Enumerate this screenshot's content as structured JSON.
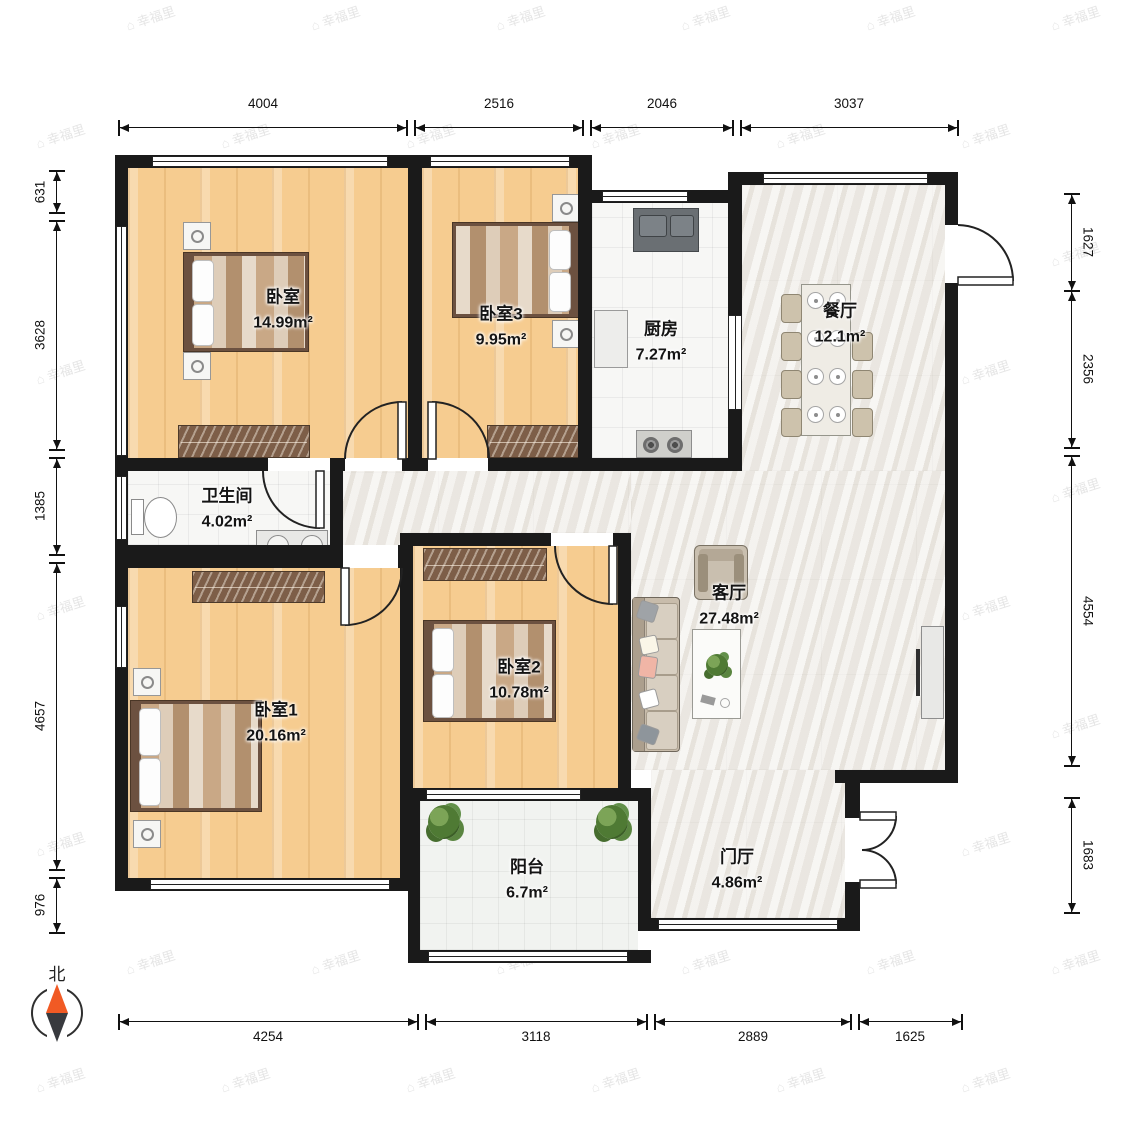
{
  "watermark": {
    "logo": "⌂",
    "text": "幸福里"
  },
  "compass": {
    "label": "北"
  },
  "rooms": {
    "master": {
      "name": "卧室",
      "area": "14.99m²"
    },
    "bedroom3": {
      "name": "卧室3",
      "area": "9.95m²"
    },
    "kitchen": {
      "name": "厨房",
      "area": "7.27m²"
    },
    "dining": {
      "name": "餐厅",
      "area": "12.1m²"
    },
    "bath": {
      "name": "卫生间",
      "area": "4.02m²"
    },
    "bedroom1": {
      "name": "卧室1",
      "area": "20.16m²"
    },
    "bedroom2": {
      "name": "卧室2",
      "area": "10.78m²"
    },
    "living": {
      "name": "客厅",
      "area": "27.48m²"
    },
    "balcony": {
      "name": "阳台",
      "area": "6.7m²"
    },
    "foyer": {
      "name": "门厅",
      "area": "4.86m²"
    }
  },
  "dimensions": {
    "top": [
      "4004",
      "2516",
      "2046",
      "3037"
    ],
    "bottom": [
      "4254",
      "3118",
      "2889",
      "1625"
    ],
    "left": [
      "631",
      "3628",
      "1385",
      "4657",
      "976"
    ],
    "right": [
      "1627",
      "2356",
      "4554",
      "1683"
    ]
  },
  "colors": {
    "wall": "#1a1a1a",
    "wood": "#F6CC90",
    "compass_north": "#F15A24"
  }
}
